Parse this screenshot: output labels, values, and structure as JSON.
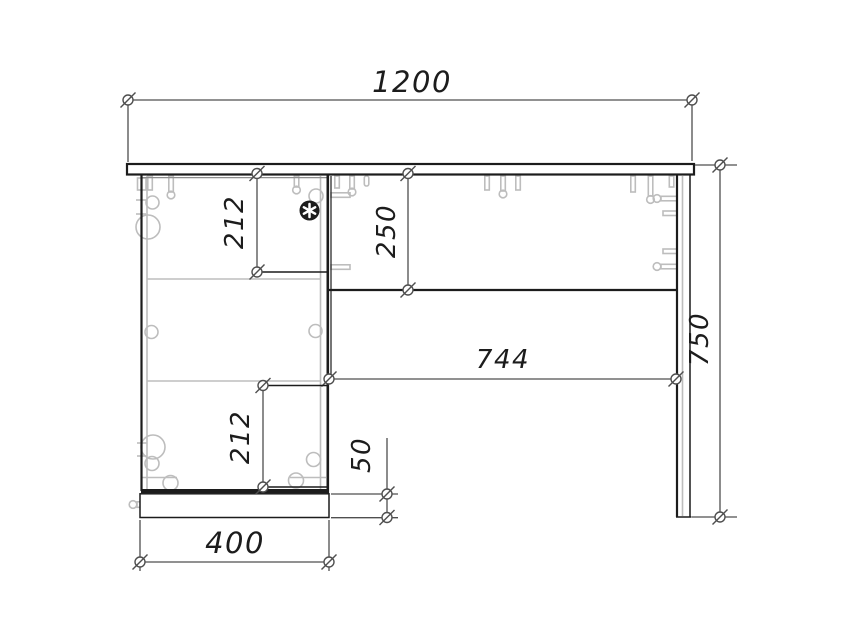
{
  "drawing": {
    "type": "furniture-assembly-front-view",
    "dims": {
      "overall_width": "1200",
      "overall_height": "750",
      "clear_span": "744",
      "pedestal_width": "400",
      "panel_drop": "250",
      "upper_section": "212",
      "lower_section": "212",
      "plinth_height": "50"
    },
    "icons": {
      "lock": "lock-knob-icon",
      "endpoint": "dim-endpoint-circle-slash",
      "hinge": "hinge-cup-icon",
      "screw": "confirmat-screw-icon"
    },
    "colors": {
      "line": "#1c1c1c",
      "dim": "#4f4f4f",
      "hardware": "#bdbdbd",
      "background": "#ffffff"
    }
  }
}
